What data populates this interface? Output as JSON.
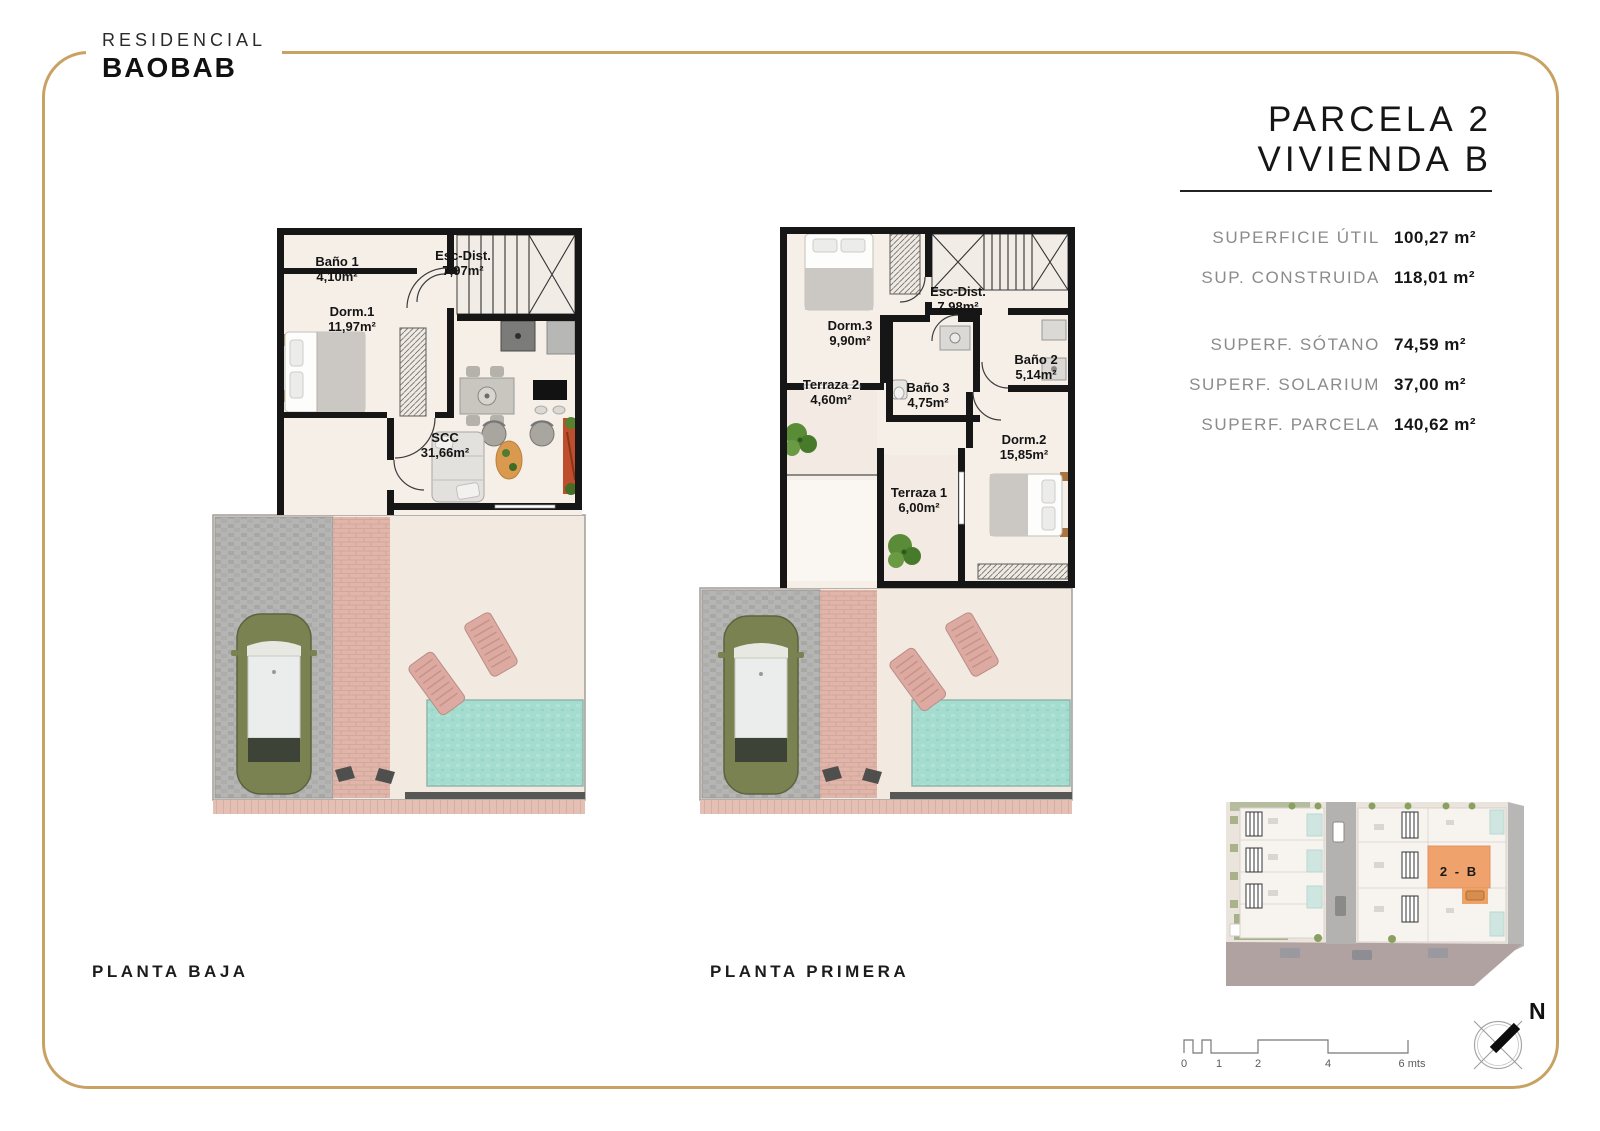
{
  "brand": {
    "line1": "RESIDENCIAL",
    "line2": "BAOBAB"
  },
  "title": {
    "line1": "PARCELA 2",
    "line2": "VIVIENDA B"
  },
  "surfaces": {
    "group1": [
      {
        "label": "SUPERFICIE ÚTIL",
        "value": "100,27 m²"
      },
      {
        "label": "SUP. CONSTRUIDA",
        "value": "118,01 m²"
      }
    ],
    "group2": [
      {
        "label": "SUPERF. SÓTANO",
        "value": "74,59 m²"
      },
      {
        "label": "SUPERF. SOLARIUM",
        "value": "37,00 m²"
      },
      {
        "label": "SUPERF. PARCELA",
        "value": "140,62 m²"
      }
    ]
  },
  "plan_baja": {
    "caption": "PLANTA BAJA",
    "rooms": {
      "bano1": {
        "name": "Baño 1",
        "area": "4,10m²"
      },
      "escdist": {
        "name": "Esc-Dist.",
        "area": "7,97m²"
      },
      "dorm1": {
        "name": "Dorm.1",
        "area": "11,97m²"
      },
      "scc": {
        "name": "SCC",
        "area": "31,66m²"
      }
    }
  },
  "plan_primera": {
    "caption": "PLANTA PRIMERA",
    "rooms": {
      "dorm3": {
        "name": "Dorm.3",
        "area": "9,90m²"
      },
      "escdist": {
        "name": "Esc-Dist.",
        "area": "7,98m²"
      },
      "bano2": {
        "name": "Baño 2",
        "area": "5,14m²"
      },
      "terraza2": {
        "name": "Terraza 2",
        "area": "4,60m²"
      },
      "bano3": {
        "name": "Baño 3",
        "area": "4,75m²"
      },
      "dorm2": {
        "name": "Dorm.2",
        "area": "15,85m²"
      },
      "terraza1": {
        "name": "Terraza 1",
        "area": "6,00m²"
      }
    }
  },
  "siteplan": {
    "highlight_label": "2 - B"
  },
  "scalebar": {
    "ticks": [
      "0",
      "1",
      "2",
      "4",
      "6 mts"
    ]
  },
  "compass": {
    "north_label": "N"
  },
  "colors": {
    "accent_gold": "#c8a262",
    "highlight_orange": "#f0a26c",
    "pool": "#a5dcd0",
    "wall_black": "#161616",
    "floor_cream": "#f6efe8"
  }
}
